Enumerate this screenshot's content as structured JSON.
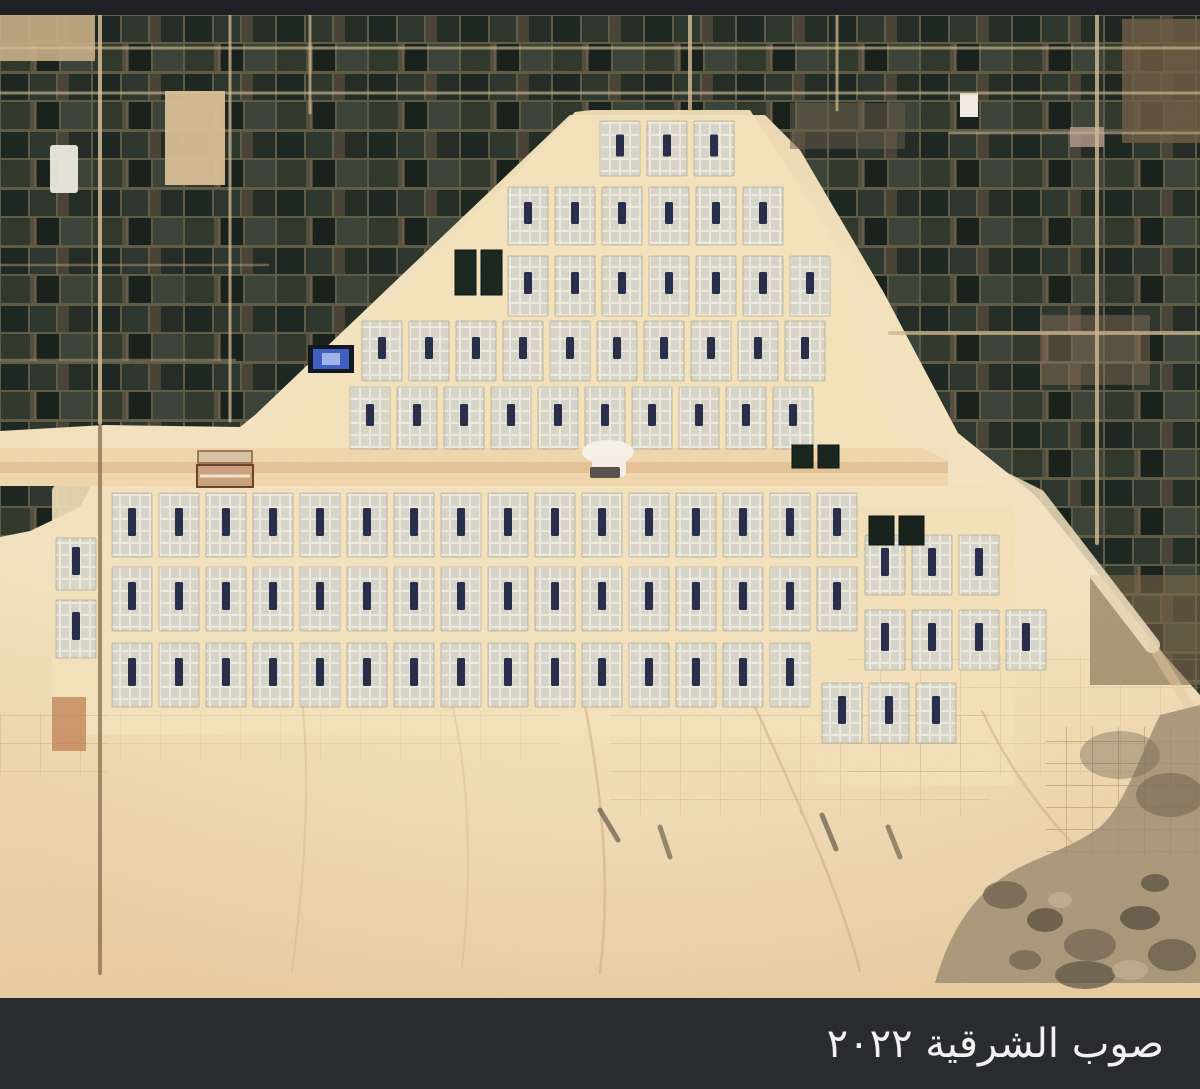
{
  "caption": {
    "text": "صوب الشرقية ٢٠٢٢"
  },
  "letterbox": {
    "top_color": "#202124",
    "bottom_color": "#2a2b2e",
    "text_color": "#f2f2f2"
  },
  "palette": {
    "sand_base": "#e9cfa6",
    "sand_bright": "#f3e2bd",
    "field_dark_green": "#1f2a23",
    "field_brown": "#55493a",
    "road_tan": "#d8c098",
    "module_cell": "#d7d5c8",
    "module_frame": "#eceadf",
    "tank_navy": "#262c49",
    "pond_green": "#16241b",
    "rocky_brown": "#8c7a5f"
  },
  "greenhouses": {
    "module": {
      "w": 40,
      "pitch": 47,
      "tank_w": 8,
      "tank_color": "#262c49"
    },
    "blocks": [
      {
        "name": "upper-pyramid",
        "tank_h": 22,
        "rows": [
          {
            "x": 600,
            "y": 106,
            "count": 3,
            "h": 55
          },
          {
            "x": 508,
            "y": 172,
            "count": 6,
            "h": 58
          },
          {
            "x": 508,
            "y": 241,
            "count": 7,
            "h": 60
          },
          {
            "x": 362,
            "y": 306,
            "count": 10,
            "h": 60
          },
          {
            "x": 350,
            "y": 372,
            "count": 10,
            "h": 62
          }
        ]
      },
      {
        "name": "lower-band",
        "tank_h": 28,
        "rows": [
          {
            "x": 112,
            "y": 478,
            "count": 16,
            "h": 64
          },
          {
            "x": 112,
            "y": 552,
            "count": 16,
            "h": 64
          },
          {
            "x": 112,
            "y": 628,
            "count": 15,
            "h": 64
          },
          {
            "x": 56,
            "y": 523,
            "count": 1,
            "h": 52
          },
          {
            "x": 56,
            "y": 585,
            "count": 1,
            "h": 58
          },
          {
            "x": 865,
            "y": 520,
            "count": 3,
            "h": 60
          },
          {
            "x": 865,
            "y": 595,
            "count": 4,
            "h": 60
          },
          {
            "x": 822,
            "y": 668,
            "count": 3,
            "h": 60
          }
        ]
      }
    ]
  },
  "ponds": [
    {
      "x": 455,
      "y": 235,
      "count": 2,
      "w": 21,
      "h": 45,
      "fill": "#18261d"
    },
    {
      "x": 792,
      "y": 430,
      "count": 2,
      "w": 21,
      "h": 23,
      "fill": "#16241b"
    },
    {
      "x": 869,
      "y": 501,
      "count": 2,
      "w": 25,
      "h": 29,
      "fill": "#142019"
    }
  ]
}
